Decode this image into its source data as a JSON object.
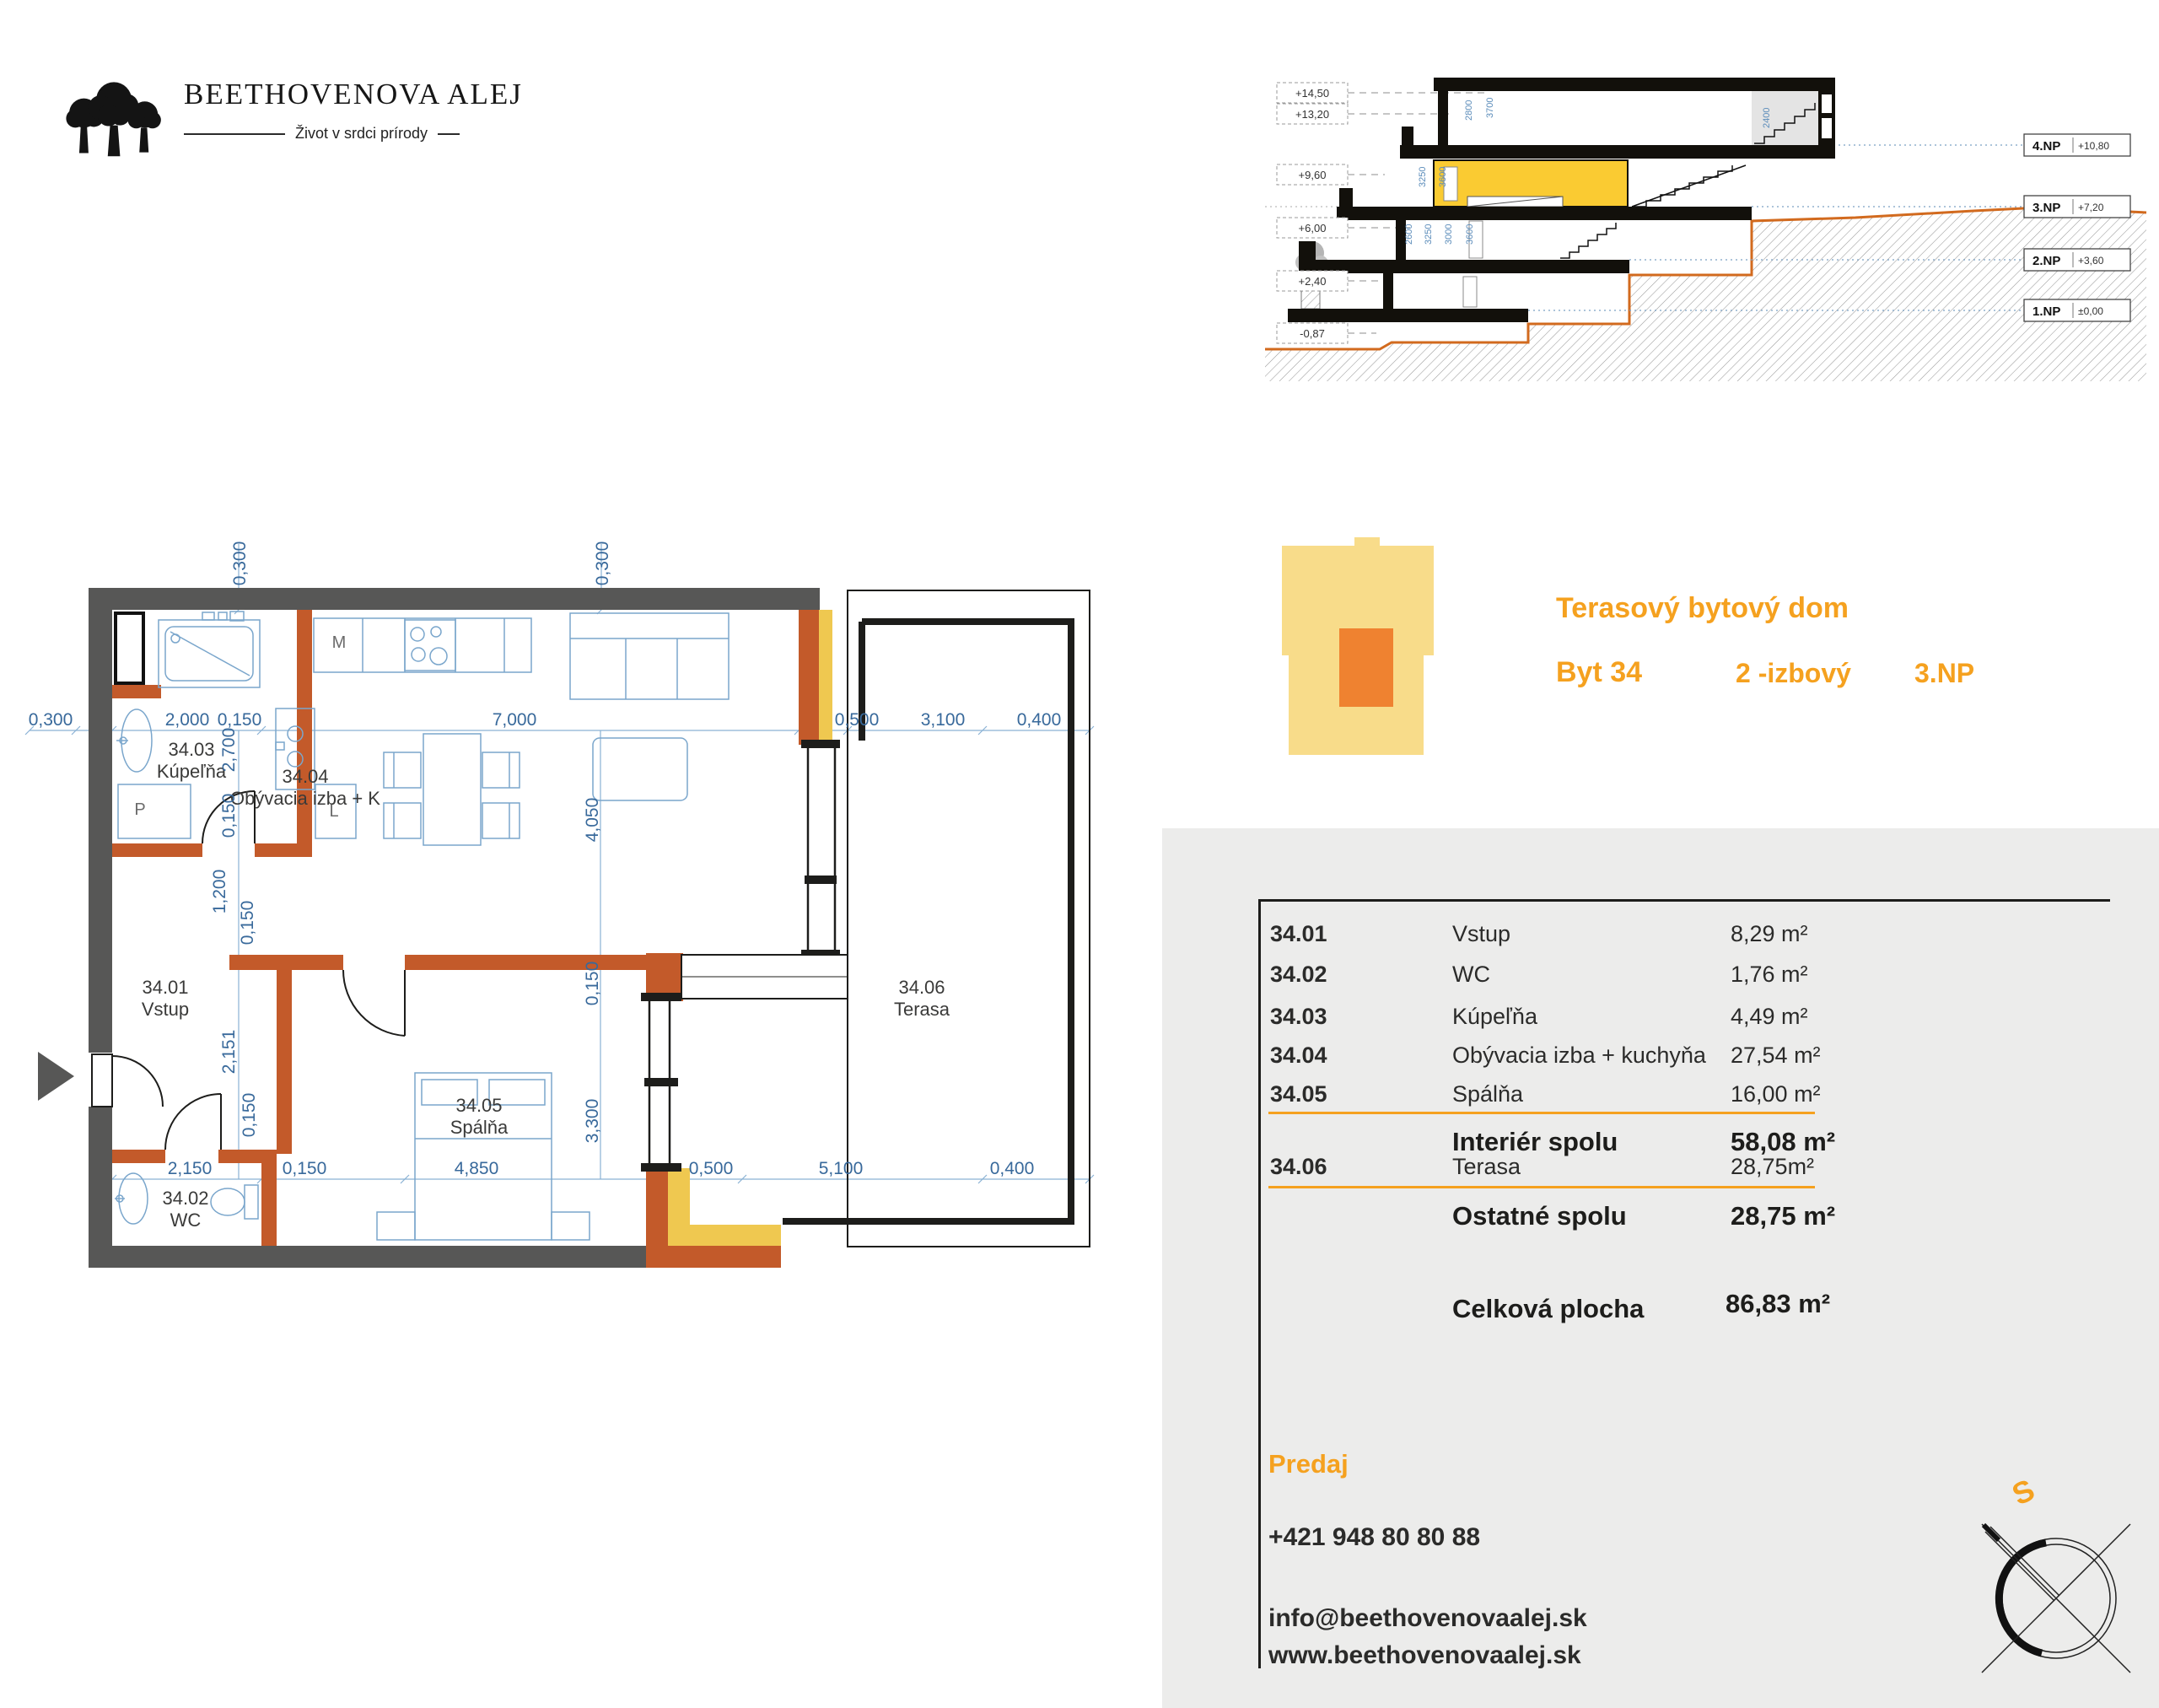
{
  "logo": {
    "title": "BEETHOVENOVA ALEJ",
    "tagline": "Život v srdci prírody"
  },
  "section": {
    "elevations": [
      "+14,50",
      "+13,20",
      "+9,60",
      "+6,00",
      "+2,40",
      "-0,87"
    ],
    "floors": [
      {
        "name": "4.NP",
        "level": "+10,80"
      },
      {
        "name": "3.NP",
        "level": "+7,20"
      },
      {
        "name": "2.NP",
        "level": "+3,60"
      },
      {
        "name": "1.NP",
        "level": "±0,00"
      }
    ],
    "dims": [
      "2800",
      "3700",
      "3250",
      "3600",
      "2400",
      "2600",
      "3250",
      "3000",
      "3600"
    ]
  },
  "unit": {
    "building_type": "Terasový bytový dom",
    "flat": "Byt 34",
    "rooms": "2 -izbový",
    "floor": "3.NP"
  },
  "plan": {
    "rooms": [
      {
        "id": "34.01",
        "name": "Vstup"
      },
      {
        "id": "34.02",
        "name": "WC"
      },
      {
        "id": "34.03",
        "name": "Kúpeľňa"
      },
      {
        "id": "34.04",
        "name": "Obývacia izba + K"
      },
      {
        "id": "34.05",
        "name": "Spálňa"
      },
      {
        "id": "34.06",
        "name": "Terasa"
      }
    ],
    "letters": {
      "m": "M",
      "p": "P",
      "l": "L"
    },
    "dims_top": [
      "0,300",
      "0,300"
    ],
    "dims_row1": [
      "0,300",
      "2,000",
      "0,150",
      "7,000",
      "0,500",
      "3,100",
      "0,400"
    ],
    "dims_row2": [
      "2,150",
      "0,150",
      "4,850",
      "0,500",
      "5,100",
      "0,400"
    ],
    "dims_left": [
      "2,700",
      "0,150",
      "1,200",
      "0,150",
      "2,151",
      "0,150"
    ],
    "dims_right": [
      "4,050",
      "0,150",
      "3,300"
    ]
  },
  "table": {
    "rows": [
      {
        "id": "34.01",
        "name": "Vstup",
        "area": "8,29 m²"
      },
      {
        "id": "34.02",
        "name": "WC",
        "area": "1,76 m²"
      },
      {
        "id": "34.03",
        "name": "Kúpeľňa",
        "area": "4,49 m²"
      },
      {
        "id": "34.04",
        "name": "Obývacia izba + kuchyňa",
        "area": "27,54 m²"
      },
      {
        "id": "34.05",
        "name": "Spálňa",
        "area": "16,00 m²"
      }
    ],
    "interior_total_label": "Interiér spolu",
    "interior_total": "58,08 m²",
    "terrace_row": {
      "id": "34.06",
      "name": "Terasa",
      "area": "28,75m²"
    },
    "other_total_label": "Ostatné spolu",
    "other_total": "28,75 m²",
    "total_label": "Celková plocha",
    "total": "86,83 m²"
  },
  "contact": {
    "heading": "Predaj",
    "phone": "+421 948 80 80 88",
    "email": "info@beethovenovaalej.sk",
    "web": "www.beethovenovaalej.sk"
  },
  "compass": {
    "south_label": "S"
  },
  "colors": {
    "accent_orange": "#F5A11F",
    "wall_dark": "#575756",
    "wall_orange": "#C35A2A",
    "wall_yellow": "#EFC850",
    "plan_blue": "#3C77AD",
    "panel_gray": "#ECECEB",
    "section_unit_yellow": "#FACB32",
    "icon_yellow": "#F8DC8A",
    "icon_orange": "#EF8230"
  }
}
